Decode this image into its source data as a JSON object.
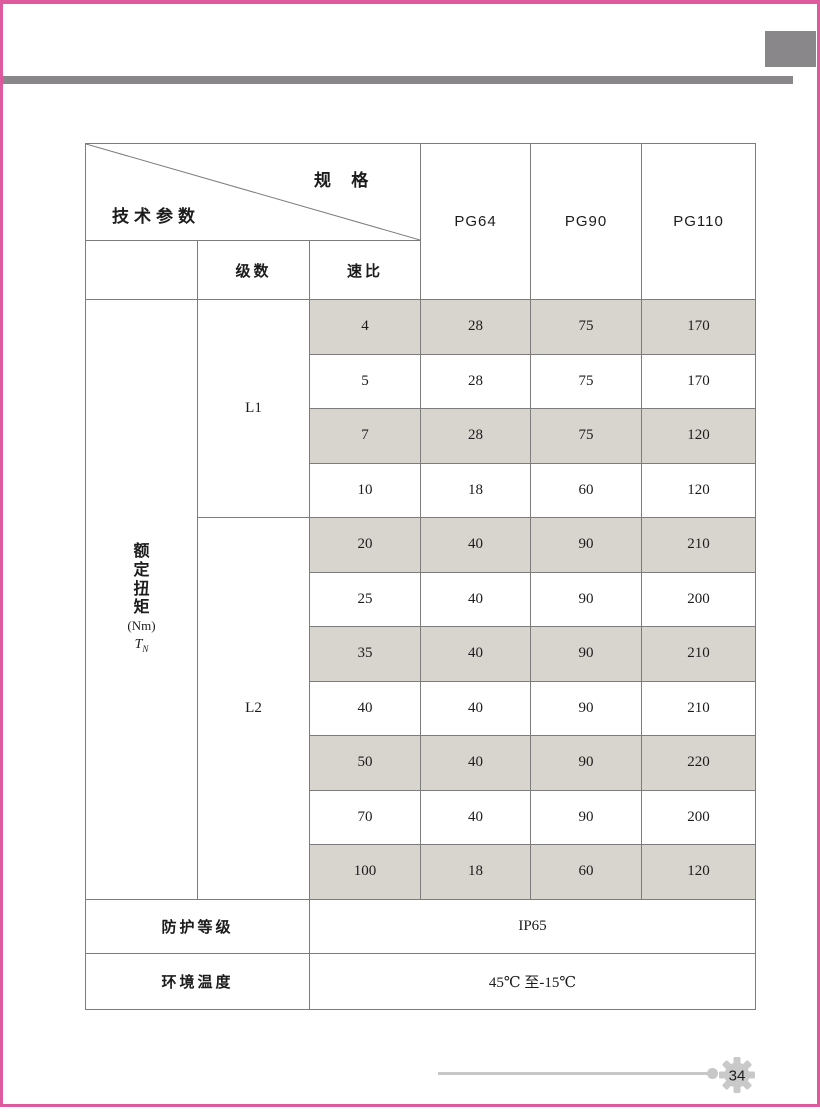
{
  "frame": {
    "accent_color": "#dd5a9e",
    "bar_color": "#8a878b",
    "shade_color": "#d8d4ce"
  },
  "table": {
    "header": {
      "spec_label": "规 格",
      "params_label": "技术参数",
      "models": [
        "PG64",
        "PG90",
        "PG110"
      ],
      "stages_label": "级数",
      "ratio_label": "速比"
    },
    "torque": {
      "chars": "额定扭矩",
      "unit": "(Nm)",
      "symbol": "T",
      "symbol_sub": "N"
    },
    "groups": [
      {
        "stage": "L1",
        "rows": [
          {
            "ratio": "4",
            "pg64": "28",
            "pg90": "75",
            "pg110": "170"
          },
          {
            "ratio": "5",
            "pg64": "28",
            "pg90": "75",
            "pg110": "170"
          },
          {
            "ratio": "7",
            "pg64": "28",
            "pg90": "75",
            "pg110": "120"
          },
          {
            "ratio": "10",
            "pg64": "18",
            "pg90": "60",
            "pg110": "120"
          }
        ]
      },
      {
        "stage": "L2",
        "rows": [
          {
            "ratio": "20",
            "pg64": "40",
            "pg90": "90",
            "pg110": "210"
          },
          {
            "ratio": "25",
            "pg64": "40",
            "pg90": "90",
            "pg110": "200"
          },
          {
            "ratio": "35",
            "pg64": "40",
            "pg90": "90",
            "pg110": "210"
          },
          {
            "ratio": "40",
            "pg64": "40",
            "pg90": "90",
            "pg110": "210"
          },
          {
            "ratio": "50",
            "pg64": "40",
            "pg90": "90",
            "pg110": "220"
          },
          {
            "ratio": "70",
            "pg64": "40",
            "pg90": "90",
            "pg110": "200"
          },
          {
            "ratio": "100",
            "pg64": "18",
            "pg90": "60",
            "pg110": "120"
          }
        ]
      }
    ],
    "extra_rows": [
      {
        "label": "防护等级",
        "value": "IP65"
      },
      {
        "label": "环境温度",
        "value": "45℃ 至-15℃"
      }
    ]
  },
  "footer": {
    "page_number": "34"
  }
}
